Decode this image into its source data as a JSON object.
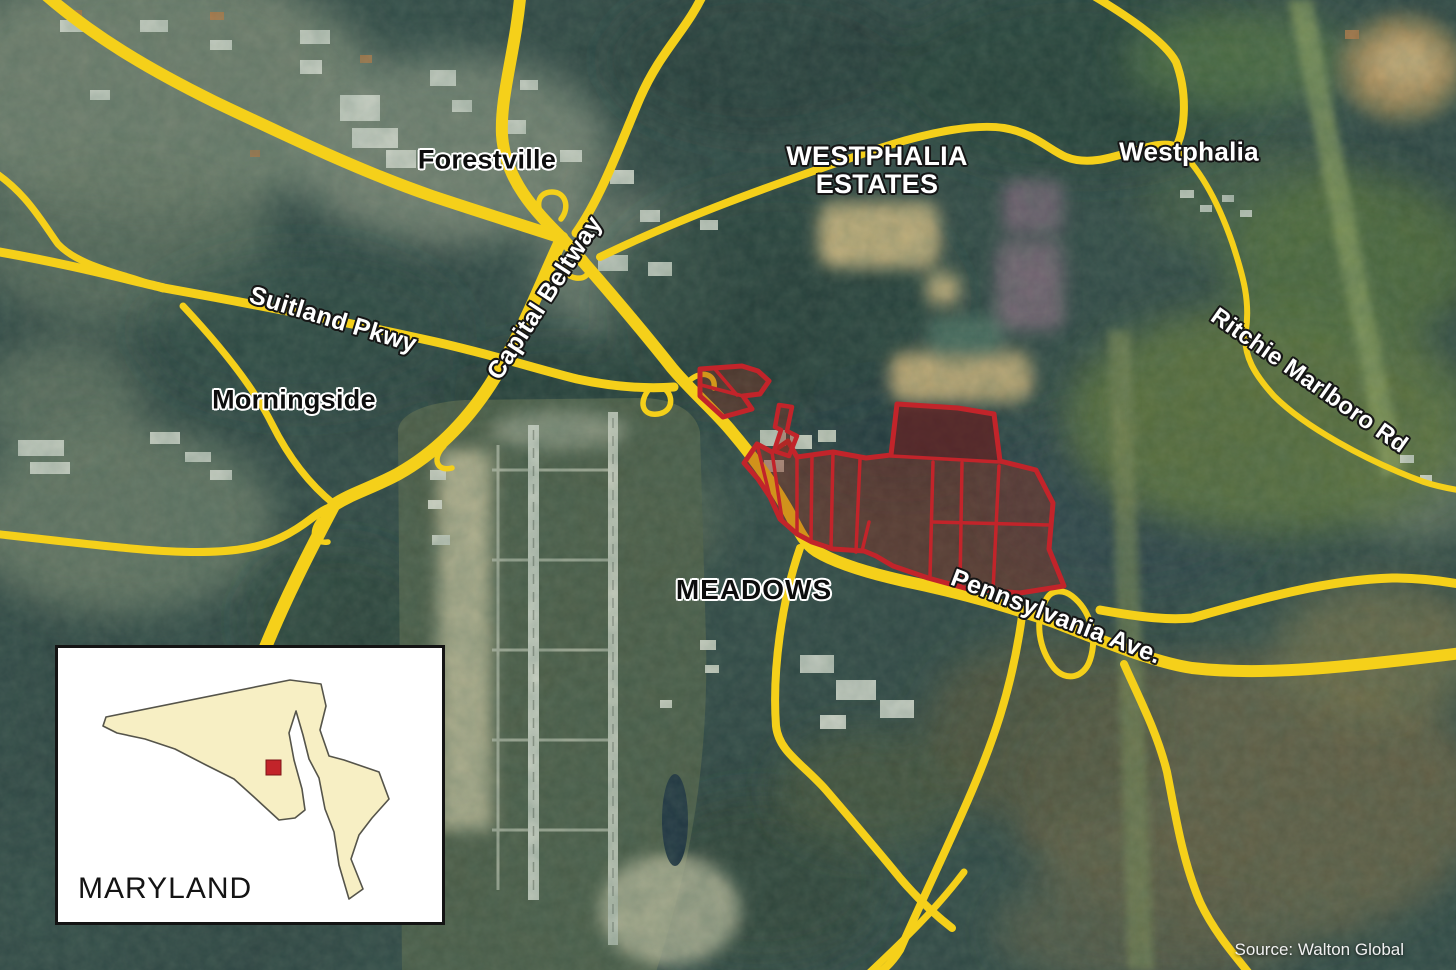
{
  "map": {
    "place_labels": {
      "forestville": "Forestville",
      "westphalia_estates": {
        "line1": "WESTPHALIA",
        "line2": "ESTATES"
      },
      "westphalia": "Westphalia",
      "morningside": "Morningside",
      "meadows": "MEADOWS"
    },
    "road_labels": {
      "suitland_pkwy": "Suitland Pkwy",
      "capital_beltway": "Capital Beltway",
      "pennsylvania_ave": "Pennsylvania Ave.",
      "ritchie_marlboro_rd": "Ritchie Marlboro Rd"
    },
    "colors": {
      "road_yellow": "#F5D01A",
      "parcel_red": "#C2242A",
      "inset_state_fill": "#F7EFC4",
      "inset_marker_red": "#C2242A"
    }
  },
  "inset": {
    "state_label": "MARYLAND"
  },
  "attribution": {
    "text": "Source: Walton Global"
  }
}
